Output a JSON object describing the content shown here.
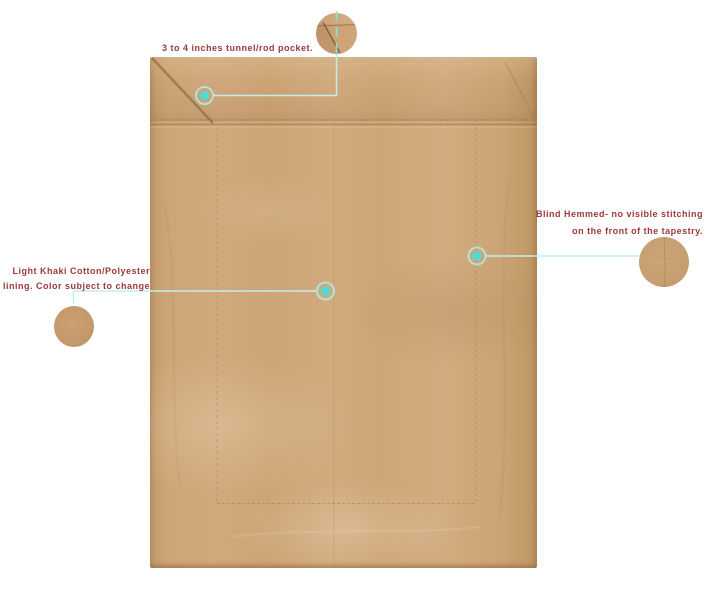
{
  "page": {
    "background": "#ffffff",
    "description": "Tapestry back view product image with feature callouts"
  },
  "colors": {
    "fabric_base": "#cfa67a",
    "annotation_text": "#9c393c",
    "callout_line": "#c0efed",
    "callout_dot": "#55d8d4",
    "callout_ring": "#abe9e6"
  },
  "annotations": {
    "rod_pocket": {
      "label": "3 to 4 inches tunnel/rod pocket."
    },
    "blind_hem": {
      "line1": "Blind Hemmed- no visible stitching",
      "line2": "on the front of the tapestry."
    },
    "lining": {
      "line1": "Light Khaki Cotton/Polyester",
      "line2": "lining. Color subject to change"
    }
  }
}
